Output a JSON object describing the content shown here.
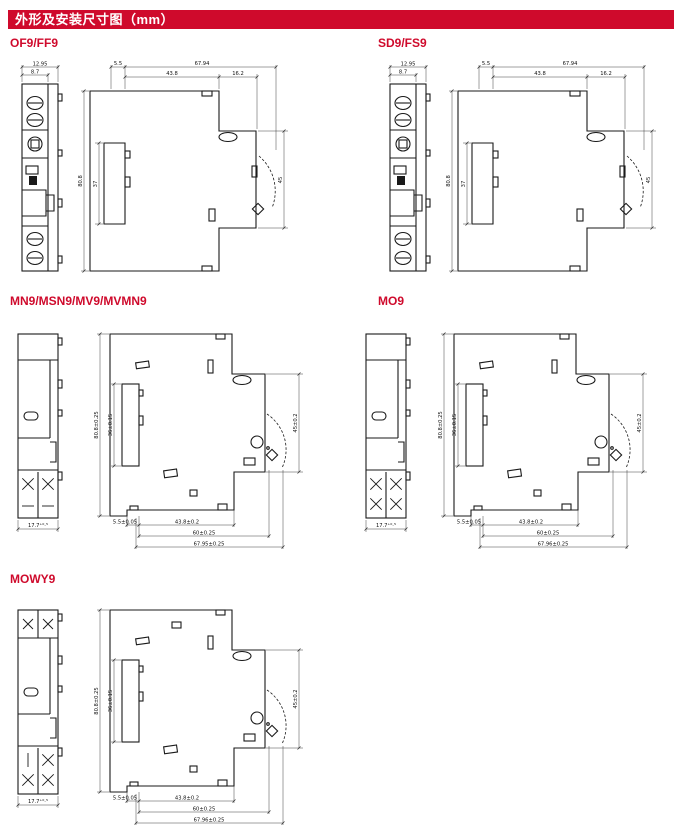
{
  "header": {
    "title": "外形及安装尺寸图（mm）"
  },
  "colors": {
    "accent": "#cf0a2c",
    "line": "#1a1a1a"
  },
  "sections": {
    "of9": {
      "label": "OF9/FF9",
      "front": {
        "dim_width": "12.95",
        "dim_width_inner": "8.7"
      },
      "side": {
        "dim_offset": "5.5",
        "dim_total": "67.94",
        "dim_main": "43.8",
        "dim_step": "16.2",
        "dim_height": "80.8",
        "dim_height_inner": "37",
        "dim_lever": "45"
      }
    },
    "sd9": {
      "label": "SD9/FS9",
      "front": {
        "dim_width": "12.95",
        "dim_width_inner": "8.7"
      },
      "side": {
        "dim_offset": "5.5",
        "dim_total": "67.94",
        "dim_main": "43.8",
        "dim_step": "16.2",
        "dim_height": "80.8",
        "dim_height_inner": "37",
        "dim_lever": "45"
      }
    },
    "mn9": {
      "label": "MN9/MSN9/MV9/MVMN9",
      "front": {
        "dim_width": "17.7⁺⁰·⁵"
      },
      "side": {
        "dim_offset": "5.5±0.05",
        "dim_main": "43.8±0.2",
        "dim_step": "60±0.25",
        "dim_total": "67.95±0.25",
        "dim_height": "80.8±0.25",
        "dim_height_inner": "36±0.15",
        "dim_lever": "45±0.2"
      }
    },
    "mo9": {
      "label": "MO9",
      "front": {
        "dim_width": "17.7⁺⁰·⁵"
      },
      "side": {
        "dim_offset": "5.5±0.05",
        "dim_main": "43.8±0.2",
        "dim_step": "60±0.25",
        "dim_total": "67.96±0.25",
        "dim_height": "80.8±0.25",
        "dim_height_inner": "36±0.15",
        "dim_lever": "45±0.2"
      }
    },
    "mowy9": {
      "label": "MOWY9",
      "front": {
        "dim_width": "17.7⁺⁰·⁵"
      },
      "side": {
        "dim_offset": "5.5±0.05",
        "dim_main": "43.8±0.2",
        "dim_step": "60±0.25",
        "dim_total": "67.96±0.25",
        "dim_height": "80.8±0.25",
        "dim_height_inner": "36±0.15",
        "dim_lever": "45±0.2"
      }
    }
  }
}
